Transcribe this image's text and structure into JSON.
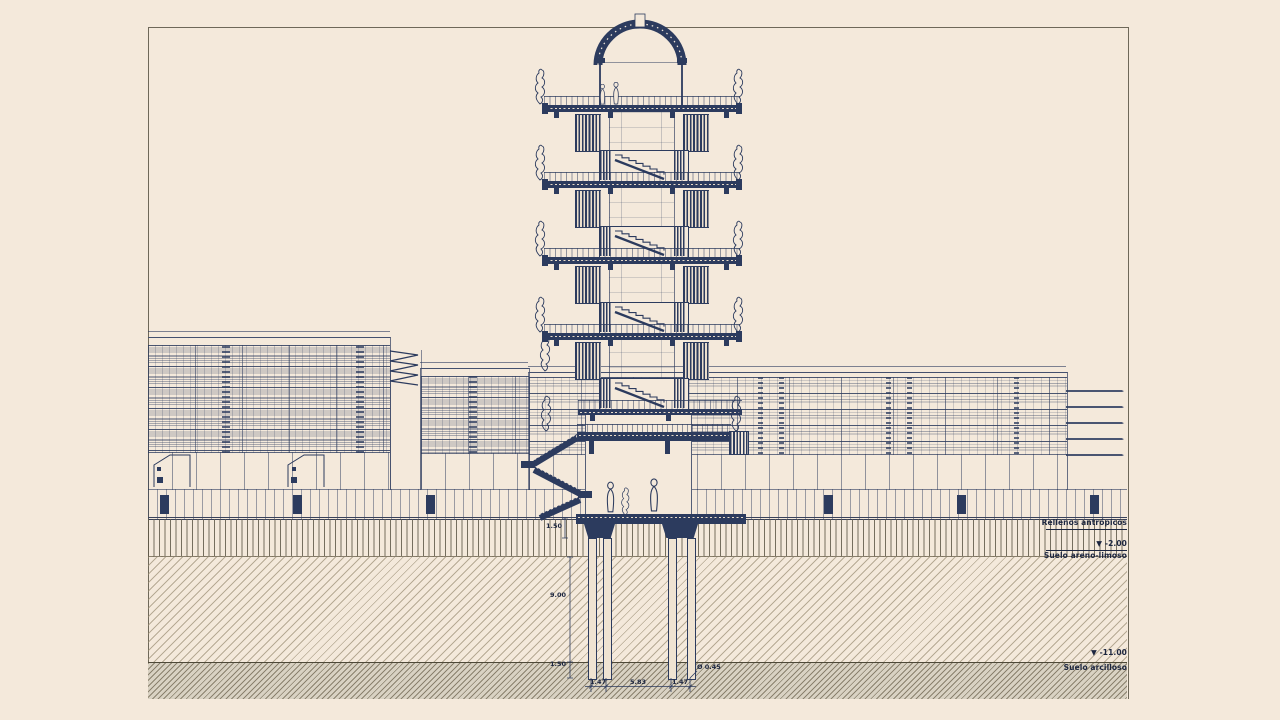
{
  "drawing": {
    "kind": "architectural longitudinal section, tower with pile foundation",
    "colors": {
      "paper": "#f4e9db",
      "ink": "#2c3b5e",
      "frame_line": "#6e6859",
      "clay_band": "#d9d2c3"
    }
  },
  "annotations": {
    "fill": "Rellenos antrópicos",
    "level_minus2": "▼ -2.00",
    "sandy": "Suelo areno-limoso",
    "level_minus11": "▼ -11.00",
    "clay": "Suelo arcilloso"
  },
  "dims": {
    "d_cap": "1.50",
    "d_pile": "9.00",
    "d_embed": "1.50",
    "d_left": "1.47",
    "d_mid": "5.83",
    "d_right": "1.47",
    "d_diam": "Ø 0.45"
  }
}
